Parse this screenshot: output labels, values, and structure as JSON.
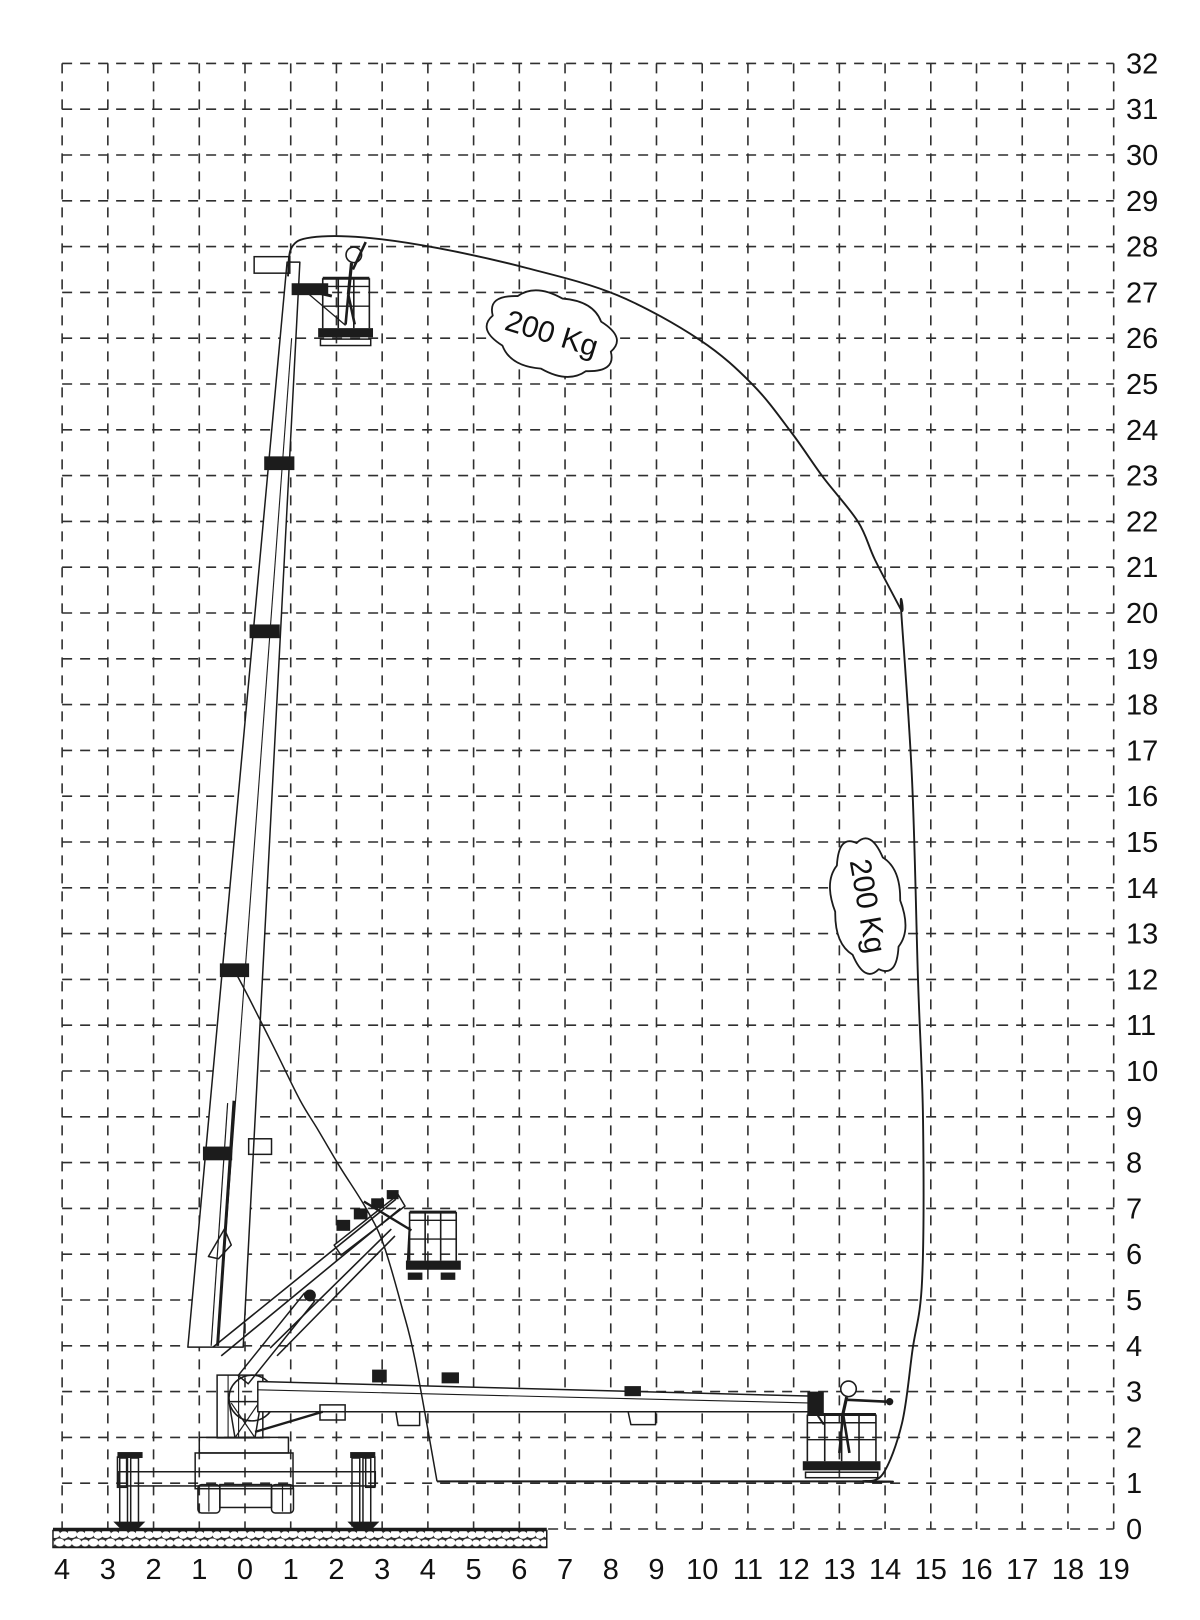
{
  "diagram_type": "aerial-platform-working-envelope",
  "colors": {
    "line": "#1c1c1c",
    "grid": "#2f2f2f",
    "background": "#ffffff",
    "text": "#111111"
  },
  "axes": {
    "x": {
      "min": -4,
      "max": 19,
      "labels": [
        "4",
        "3",
        "2",
        "1",
        "0",
        "1",
        "2",
        "3",
        "4",
        "5",
        "6",
        "7",
        "8",
        "9",
        "10",
        "11",
        "12",
        "13",
        "14",
        "15",
        "16",
        "17",
        "18",
        "19"
      ]
    },
    "y": {
      "min": 0,
      "max": 32,
      "labels": [
        "0",
        "1",
        "2",
        "3",
        "4",
        "5",
        "6",
        "7",
        "8",
        "9",
        "10",
        "11",
        "12",
        "13",
        "14",
        "15",
        "16",
        "17",
        "18",
        "19",
        "20",
        "21",
        "22",
        "23",
        "24",
        "25",
        "26",
        "27",
        "28",
        "29",
        "30",
        "31",
        "32"
      ]
    }
  },
  "load_labels": [
    {
      "text": "200 Kg",
      "cx": 6.71,
      "cy": 26.1,
      "rx": 1.35,
      "ry": 0.8,
      "rot": 17,
      "bumps": 8
    },
    {
      "text": "200 Kg",
      "cx": 13.62,
      "cy": 13.6,
      "rx": 1.4,
      "ry": 0.72,
      "rot": 80,
      "bumps": 8
    }
  ],
  "envelope": {
    "outer": [
      [
        0.94,
        27.35
      ],
      [
        1.02,
        27.98
      ],
      [
        1.45,
        28.2
      ],
      [
        2.6,
        28.2
      ],
      [
        4.2,
        27.97
      ],
      [
        6.17,
        27.53
      ],
      [
        8.14,
        26.94
      ],
      [
        9.95,
        25.96
      ],
      [
        11.11,
        24.98
      ],
      [
        11.96,
        23.93
      ],
      [
        12.64,
        22.97
      ],
      [
        13.41,
        21.99
      ],
      [
        13.78,
        21.16
      ],
      [
        14.35,
        20.07
      ],
      [
        14.35,
        20.07
      ],
      [
        14.59,
        16.35
      ],
      [
        14.72,
        12.0
      ],
      [
        14.83,
        8.93
      ],
      [
        14.81,
        5.44
      ],
      [
        14.6,
        3.91
      ],
      [
        14.37,
        2.31
      ],
      [
        13.95,
        1.2
      ],
      [
        13.5,
        1.04
      ],
      [
        13.5,
        1.04
      ],
      [
        4.2,
        1.04
      ]
    ],
    "inner_arc": [
      [
        4.2,
        1.04
      ],
      [
        3.72,
        3.69
      ],
      [
        3.43,
        4.85
      ],
      [
        3.02,
        6.24
      ],
      [
        2.63,
        7.03
      ],
      [
        2.08,
        7.9
      ],
      [
        1.6,
        8.71
      ],
      [
        1.2,
        9.37
      ],
      [
        0.66,
        10.46
      ],
      [
        0.11,
        11.55
      ],
      [
        -0.18,
        12.1
      ]
    ]
  },
  "ground": {
    "x1": -4.2,
    "x2": 6.6,
    "h_px": 17
  },
  "machine": {
    "parts": [
      {
        "t": "r",
        "x": -2.76,
        "y": 1.25,
        "w": 5.61,
        "h": 0.31
      },
      {
        "t": "r",
        "x": -2.79,
        "y": 1.57,
        "w": 0.2,
        "h": 0.66
      },
      {
        "t": "r",
        "x": 2.64,
        "y": 1.57,
        "w": 0.2,
        "h": 0.66
      },
      {
        "t": "r",
        "x": -2.74,
        "y": 1.55,
        "w": 0.17,
        "h": 1.48
      },
      {
        "t": "r",
        "x": -2.5,
        "y": 1.55,
        "w": 0.17,
        "h": 1.48
      },
      {
        "t": "r",
        "x": -2.79,
        "y": 1.68,
        "w": 0.55,
        "h": 0.13,
        "f": "k"
      },
      {
        "t": "p",
        "pts": [
          [
            -2.88,
            0.16
          ],
          [
            -2.18,
            0.16
          ],
          [
            -2.32,
            0.02
          ],
          [
            -2.74,
            0.02
          ]
        ],
        "c": 1,
        "f": "k"
      },
      {
        "t": "r",
        "x": 2.34,
        "y": 1.55,
        "w": 0.17,
        "h": 1.48
      },
      {
        "t": "r",
        "x": 2.58,
        "y": 1.55,
        "w": 0.17,
        "h": 1.48
      },
      {
        "t": "r",
        "x": 2.3,
        "y": 1.68,
        "w": 0.55,
        "h": 0.13,
        "f": "k"
      },
      {
        "t": "p",
        "pts": [
          [
            2.24,
            0.16
          ],
          [
            2.94,
            0.16
          ],
          [
            2.8,
            0.02
          ],
          [
            2.38,
            0.02
          ]
        ],
        "c": 1,
        "f": "k"
      },
      {
        "t": "r",
        "x": -1.09,
        "y": 1.66,
        "w": 2.14,
        "h": 0.78
      },
      {
        "t": "r",
        "x": -1.03,
        "y": 0.97,
        "w": 0.48,
        "h": 0.62,
        "rx": 0.08
      },
      {
        "t": "l",
        "x1": -0.79,
        "y1": 0.97,
        "x2": -0.79,
        "y2": 0.38,
        "w": 1.2
      },
      {
        "t": "r",
        "x": 0.58,
        "y": 0.97,
        "w": 0.48,
        "h": 0.62,
        "rx": 0.08
      },
      {
        "t": "l",
        "x1": 0.82,
        "y1": 0.97,
        "x2": 0.82,
        "y2": 0.38,
        "w": 1.2
      },
      {
        "t": "r",
        "x": -0.55,
        "y": 0.97,
        "w": 1.13,
        "h": 0.5
      },
      {
        "t": "r",
        "x": -1.0,
        "y": 2.0,
        "w": 1.95,
        "h": 0.34
      },
      {
        "t": "p",
        "pts": [
          [
            -0.35,
            2.78
          ],
          [
            0.35,
            2.78
          ],
          [
            0.22,
            2.0
          ],
          [
            -0.22,
            2.0
          ]
        ],
        "c": 1
      },
      {
        "t": "l",
        "x1": -0.3,
        "y1": 2.75,
        "x2": 0.2,
        "y2": 2.02,
        "w": 1.2
      },
      {
        "t": "l",
        "x1": 0.3,
        "y1": 2.75,
        "x2": -0.2,
        "y2": 2.02,
        "w": 1.2
      },
      {
        "t": "c",
        "cx": 0.15,
        "cy": 2.86,
        "r": 0.5
      },
      {
        "t": "r",
        "x": -0.61,
        "y": 3.36,
        "w": 1.0,
        "h": 1.37
      },
      {
        "t": "l",
        "x1": -0.37,
        "y1": 3.36,
        "x2": -0.37,
        "y2": 2.0,
        "w": 1.1
      },
      {
        "t": "l",
        "x1": -0.14,
        "y1": 3.36,
        "x2": -0.14,
        "y2": 2.0,
        "w": 1.1
      },
      {
        "t": "p",
        "pts": [
          [
            -1.25,
            3.97
          ],
          [
            0.92,
            27.66
          ],
          [
            1.2,
            27.66
          ],
          [
            -0.04,
            3.97
          ]
        ],
        "c": 1,
        "f": "w"
      },
      {
        "t": "l",
        "x1": -0.6,
        "y1": 4.0,
        "x2": 1.02,
        "y2": 26.0,
        "w": 1.1
      },
      {
        "t": "r",
        "x": 0.42,
        "y": 23.42,
        "w": 0.66,
        "h": 0.3,
        "f": "k"
      },
      {
        "t": "r",
        "x": 0.1,
        "y": 19.75,
        "w": 0.66,
        "h": 0.3,
        "f": "k"
      },
      {
        "t": "r",
        "x": -0.55,
        "y": 12.35,
        "w": 0.64,
        "h": 0.3,
        "f": "k"
      },
      {
        "t": "r",
        "x": -0.92,
        "y": 8.35,
        "w": 0.64,
        "h": 0.3,
        "f": "k"
      },
      {
        "t": "r",
        "x": 0.08,
        "y": 8.52,
        "w": 0.5,
        "h": 0.34
      },
      {
        "t": "l",
        "x1": -0.6,
        "y1": 4.0,
        "x2": -0.24,
        "y2": 9.35,
        "w": 3
      },
      {
        "t": "l",
        "x1": -0.74,
        "y1": 4.0,
        "x2": -0.38,
        "y2": 9.3,
        "w": 1.2
      },
      {
        "t": "p",
        "pts": [
          [
            -0.8,
            5.95
          ],
          [
            -0.45,
            6.55
          ],
          [
            -0.3,
            6.2
          ],
          [
            -0.58,
            5.9
          ]
        ],
        "c": 1
      },
      {
        "t": "r",
        "x": 0.2,
        "y": 27.78,
        "w": 0.78,
        "h": 0.36
      },
      {
        "t": "r",
        "x": 1.02,
        "y": 27.2,
        "w": 0.8,
        "h": 0.26,
        "f": "k"
      },
      {
        "t": "l",
        "x1": 1.1,
        "y1": 27.1,
        "x2": 1.9,
        "y2": 26.92,
        "w": 3
      },
      {
        "t": "l",
        "x1": 1.35,
        "y1": 27.0,
        "x2": 2.2,
        "y2": 26.28,
        "w": 1.3
      },
      {
        "t": "l",
        "x1": 1.7,
        "y1": 27.31,
        "x2": 2.72,
        "y2": 27.31,
        "w": 3
      },
      {
        "t": "l",
        "x1": 1.7,
        "y1": 27.13,
        "x2": 2.72,
        "y2": 27.13,
        "w": 1.4
      },
      {
        "t": "l",
        "x1": 1.7,
        "y1": 26.7,
        "x2": 2.72,
        "y2": 26.7,
        "w": 1.4
      },
      {
        "t": "l",
        "x1": 1.7,
        "y1": 27.31,
        "x2": 1.7,
        "y2": 26.22,
        "w": 1.6
      },
      {
        "t": "l",
        "x1": 2.04,
        "y1": 27.31,
        "x2": 2.04,
        "y2": 26.22,
        "w": 1.6
      },
      {
        "t": "l",
        "x1": 2.38,
        "y1": 27.31,
        "x2": 2.38,
        "y2": 26.22,
        "w": 1.6
      },
      {
        "t": "l",
        "x1": 2.72,
        "y1": 27.31,
        "x2": 2.72,
        "y2": 26.22,
        "w": 1.6
      },
      {
        "t": "r",
        "x": 1.6,
        "y": 26.22,
        "w": 1.2,
        "h": 0.2,
        "f": "k"
      },
      {
        "t": "r",
        "x": 1.65,
        "y": 25.98,
        "w": 1.1,
        "h": 0.14
      },
      {
        "t": "c",
        "cx": 2.38,
        "cy": 27.82,
        "r": 0.17,
        "f": "w"
      },
      {
        "t": "l",
        "x1": 2.33,
        "y1": 27.64,
        "x2": 2.26,
        "y2": 26.95,
        "w": 3.2
      },
      {
        "t": "l",
        "x1": 2.36,
        "y1": 27.5,
        "x2": 2.64,
        "y2": 28.1,
        "w": 2.6
      },
      {
        "t": "l",
        "x1": 2.26,
        "y1": 26.95,
        "x2": 2.2,
        "y2": 26.3,
        "w": 2.6
      },
      {
        "t": "l",
        "x1": 2.26,
        "y1": 26.95,
        "x2": 2.4,
        "y2": 26.3,
        "w": 2.6
      },
      {
        "t": "l",
        "x1": -0.7,
        "y1": 3.97,
        "x2": 3.3,
        "y2": 7.2,
        "w": 1.6
      },
      {
        "t": "l",
        "x1": -0.52,
        "y1": 3.78,
        "x2": 3.4,
        "y2": 7.0,
        "w": 1.6
      },
      {
        "t": "l",
        "x1": 0.55,
        "y1": 3.95,
        "x2": 3.2,
        "y2": 6.55,
        "w": 1.6
      },
      {
        "t": "l",
        "x1": 0.7,
        "y1": 3.78,
        "x2": 3.28,
        "y2": 6.4,
        "w": 1.6
      },
      {
        "t": "p",
        "pts": [
          [
            -0.15,
            3.35
          ],
          [
            1.3,
            5.15
          ],
          [
            1.52,
            4.97
          ],
          [
            0.07,
            3.17
          ]
        ],
        "c": 1
      },
      {
        "t": "c",
        "cx": 1.42,
        "cy": 5.1,
        "r": 0.13,
        "f": "k"
      },
      {
        "t": "p",
        "pts": [
          [
            1.95,
            6.2
          ],
          [
            3.35,
            7.3
          ],
          [
            3.5,
            7.05
          ],
          [
            2.1,
            5.98
          ]
        ],
        "c": 1
      },
      {
        "t": "r",
        "x": 2.0,
        "y": 6.75,
        "w": 0.3,
        "h": 0.24,
        "f": "k"
      },
      {
        "t": "r",
        "x": 2.38,
        "y": 7.0,
        "w": 0.3,
        "h": 0.24,
        "f": "k"
      },
      {
        "t": "r",
        "x": 2.76,
        "y": 7.22,
        "w": 0.28,
        "h": 0.22,
        "f": "k"
      },
      {
        "t": "r",
        "x": 3.1,
        "y": 7.4,
        "w": 0.26,
        "h": 0.2,
        "f": "k"
      },
      {
        "t": "l",
        "x1": 2.6,
        "y1": 7.15,
        "x2": 3.64,
        "y2": 6.52,
        "w": 2.4
      },
      {
        "t": "l",
        "x1": 3.6,
        "y1": 6.6,
        "x2": 3.56,
        "y2": 5.84,
        "w": 2
      },
      {
        "t": "l",
        "x1": 3.6,
        "y1": 6.92,
        "x2": 4.62,
        "y2": 6.92,
        "w": 3
      },
      {
        "t": "l",
        "x1": 3.6,
        "y1": 6.74,
        "x2": 4.62,
        "y2": 6.74,
        "w": 1.4
      },
      {
        "t": "l",
        "x1": 3.6,
        "y1": 6.33,
        "x2": 4.62,
        "y2": 6.33,
        "w": 1.4
      },
      {
        "t": "l",
        "x1": 3.6,
        "y1": 6.92,
        "x2": 3.6,
        "y2": 5.86,
        "w": 1.6
      },
      {
        "t": "l",
        "x1": 3.94,
        "y1": 6.92,
        "x2": 3.94,
        "y2": 5.86,
        "w": 1.6
      },
      {
        "t": "l",
        "x1": 4.28,
        "y1": 6.92,
        "x2": 4.28,
        "y2": 5.86,
        "w": 1.6
      },
      {
        "t": "l",
        "x1": 4.62,
        "y1": 6.92,
        "x2": 4.62,
        "y2": 5.86,
        "w": 1.6
      },
      {
        "t": "r",
        "x": 3.52,
        "y": 5.86,
        "w": 1.2,
        "h": 0.2,
        "f": "k"
      },
      {
        "t": "r",
        "x": 3.56,
        "y": 5.6,
        "w": 0.32,
        "h": 0.16,
        "f": "k"
      },
      {
        "t": "r",
        "x": 4.28,
        "y": 5.6,
        "w": 0.32,
        "h": 0.16,
        "f": "k"
      },
      {
        "t": "p",
        "pts": [
          [
            0.28,
            3.22
          ],
          [
            12.42,
            2.9
          ],
          [
            12.42,
            2.56
          ],
          [
            0.28,
            2.56
          ]
        ],
        "c": 1,
        "f": "w"
      },
      {
        "t": "l",
        "x1": 0.28,
        "y1": 3.04,
        "x2": 12.42,
        "y2": 2.75,
        "w": 1.1
      },
      {
        "t": "r",
        "x": 2.78,
        "y": 3.48,
        "w": 0.32,
        "h": 0.28,
        "f": "k"
      },
      {
        "t": "r",
        "x": 4.3,
        "y": 3.42,
        "w": 0.38,
        "h": 0.24,
        "f": "k"
      },
      {
        "t": "p",
        "pts": [
          [
            3.3,
            2.56
          ],
          [
            3.35,
            2.26
          ],
          [
            3.82,
            2.26
          ],
          [
            3.82,
            2.56
          ]
        ]
      },
      {
        "t": "r",
        "x": 8.3,
        "y": 3.12,
        "w": 0.36,
        "h": 0.22,
        "f": "k"
      },
      {
        "t": "p",
        "pts": [
          [
            8.38,
            2.56
          ],
          [
            8.44,
            2.28
          ],
          [
            8.98,
            2.28
          ],
          [
            8.98,
            2.56
          ]
        ]
      },
      {
        "t": "r",
        "x": 1.64,
        "y": 2.71,
        "w": 0.55,
        "h": 0.33
      },
      {
        "t": "l",
        "x1": 0.22,
        "y1": 2.12,
        "x2": 1.7,
        "y2": 2.56,
        "w": 2.4
      },
      {
        "t": "r",
        "x": 12.3,
        "y": 3.0,
        "w": 0.36,
        "h": 0.5,
        "f": "k"
      },
      {
        "t": "l",
        "x1": 12.5,
        "y1": 2.52,
        "x2": 12.66,
        "y2": 2.28,
        "w": 2
      },
      {
        "t": "l",
        "x1": 12.3,
        "y1": 2.5,
        "x2": 13.8,
        "y2": 2.5,
        "w": 3
      },
      {
        "t": "l",
        "x1": 12.3,
        "y1": 2.32,
        "x2": 13.8,
        "y2": 2.32,
        "w": 1.4
      },
      {
        "t": "l",
        "x1": 12.3,
        "y1": 1.95,
        "x2": 13.8,
        "y2": 1.95,
        "w": 1.4
      },
      {
        "t": "l",
        "x1": 12.3,
        "y1": 2.5,
        "x2": 12.3,
        "y2": 1.48,
        "w": 1.6
      },
      {
        "t": "l",
        "x1": 12.68,
        "y1": 2.5,
        "x2": 12.68,
        "y2": 1.48,
        "w": 1.6
      },
      {
        "t": "l",
        "x1": 13.05,
        "y1": 2.5,
        "x2": 13.05,
        "y2": 1.48,
        "w": 1.6
      },
      {
        "t": "l",
        "x1": 13.43,
        "y1": 2.5,
        "x2": 13.43,
        "y2": 1.48,
        "w": 1.6
      },
      {
        "t": "l",
        "x1": 13.8,
        "y1": 2.5,
        "x2": 13.8,
        "y2": 1.48,
        "w": 1.6
      },
      {
        "t": "r",
        "x": 12.2,
        "y": 1.48,
        "w": 1.7,
        "h": 0.2,
        "f": "k"
      },
      {
        "t": "r",
        "x": 12.26,
        "y": 1.24,
        "w": 1.58,
        "h": 0.12
      },
      {
        "t": "c",
        "cx": 13.2,
        "cy": 3.06,
        "r": 0.17,
        "f": "w"
      },
      {
        "t": "l",
        "x1": 13.16,
        "y1": 2.88,
        "x2": 13.08,
        "y2": 2.52,
        "w": 3.2
      },
      {
        "t": "l",
        "x1": 13.18,
        "y1": 2.82,
        "x2": 14.04,
        "y2": 2.78,
        "w": 2.6
      },
      {
        "t": "c",
        "cx": 14.1,
        "cy": 2.78,
        "r": 0.08,
        "f": "k"
      },
      {
        "t": "l",
        "x1": 13.08,
        "y1": 2.52,
        "x2": 13.0,
        "y2": 1.66,
        "w": 2.6
      },
      {
        "t": "l",
        "x1": 13.08,
        "y1": 2.52,
        "x2": 13.22,
        "y2": 1.66,
        "w": 2.6
      }
    ]
  }
}
